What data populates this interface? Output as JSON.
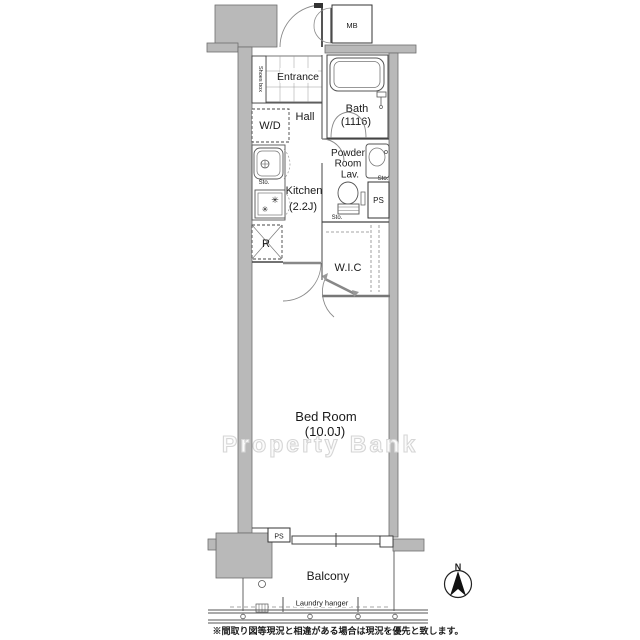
{
  "plan": {
    "labels": {
      "mb": "MB",
      "shoes_box": "Shoes box",
      "entrance": "Entrance",
      "bath": "Bath",
      "bath_size": "(1116)",
      "hall": "Hall",
      "wd": "W/D",
      "powder_line1": "Powder",
      "powder_line2": "Room",
      "powder_line3": "Lav.",
      "sto_lav": "Sto.",
      "sto_toilet": "Sto.",
      "sto_kitchen": "Sto.",
      "ps_middle": "PS",
      "kitchen": "Kitchen",
      "kitchen_size": "(2.2J)",
      "refrigerator": "R",
      "wic": "W.I.C",
      "bedroom": "Bed Room",
      "bedroom_size": "(10.0J)",
      "ps_bottom": "PS",
      "balcony": "Balcony",
      "laundry_hanger": "Laundry hanger",
      "burner1": "✳",
      "burner2": "✳"
    },
    "compass": {
      "north": "N"
    },
    "watermark": "Property Bank",
    "disclaimer": "※間取り図等現況と相違がある場合は現況を優先と致します。",
    "colors": {
      "wall": "#b9b9b9",
      "line": "#333333",
      "watermark_stroke": "#d6d6d6"
    }
  }
}
